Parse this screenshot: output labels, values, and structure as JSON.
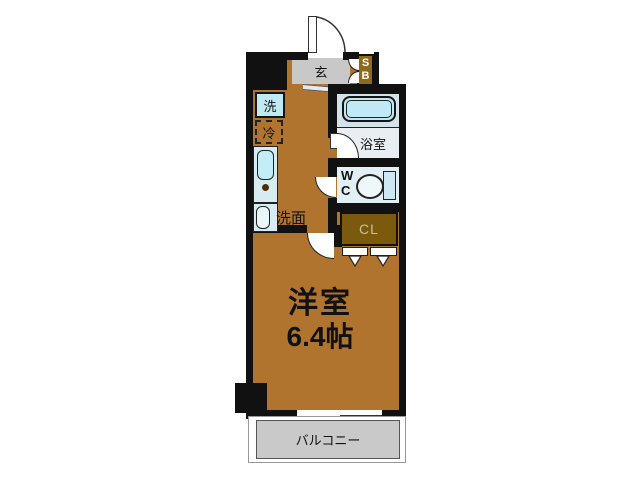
{
  "plan": {
    "type": "apartment-floor-plan",
    "labels": {
      "entrance": "玄",
      "shoe_box_top": "S",
      "shoe_box_bottom": "B",
      "washer": "洗",
      "refrigerator": "冷",
      "washstand": "洗面",
      "bathroom": "浴室",
      "toilet_w": "W",
      "toilet_c": "C",
      "closet": "CL",
      "balcony": "バルコニー"
    },
    "room": {
      "name": "洋室",
      "size": "6.4帖"
    },
    "colors": {
      "wall": "#111111",
      "floor": "#b0742e",
      "closet_fill": "#7b5a0e",
      "shoe_box_fill": "#8f6a1c",
      "entrance_floor": "#c8c8c8",
      "balcony_fill": "#c9c9c9",
      "fixture_blue": "#bfe9f4",
      "bath_floor": "#d4e2ea"
    }
  }
}
